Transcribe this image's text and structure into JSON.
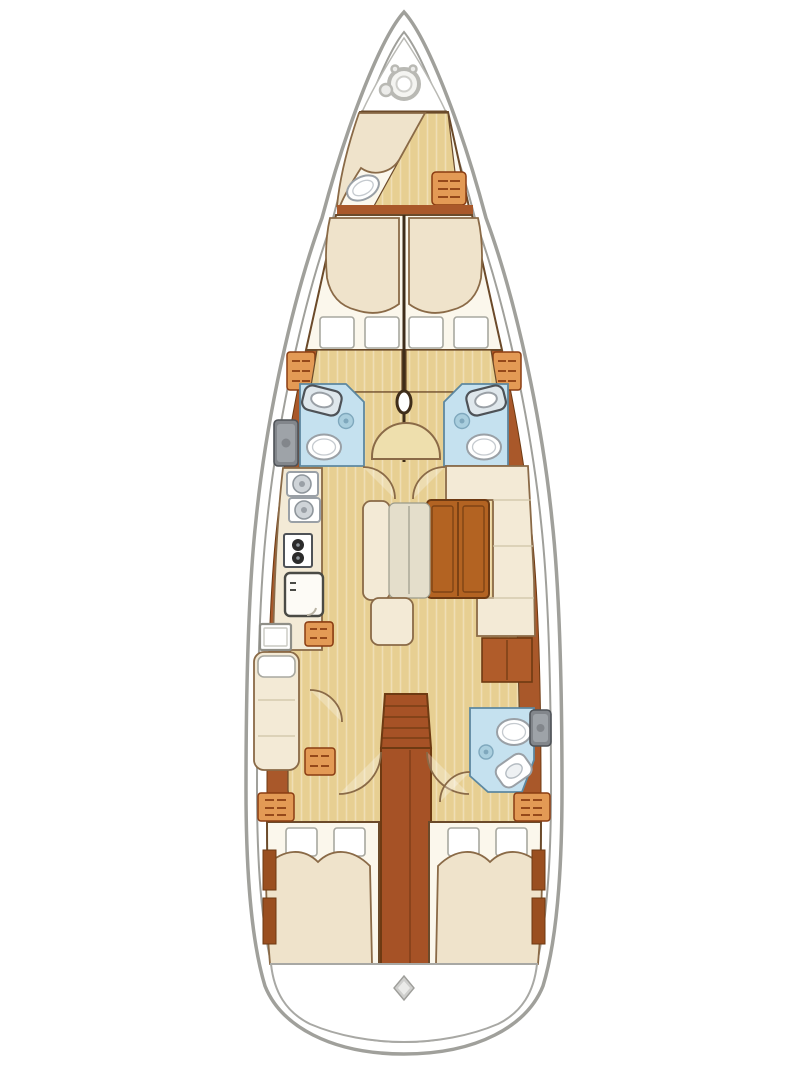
{
  "meta": {
    "title": "Sailing yacht interior layout plan, top view",
    "diagram_type": "boat-floor-plan",
    "visible_text": "none"
  },
  "palette": {
    "hull_line": "#a0a09b",
    "deck": "#ffffff",
    "wood": "#a9582a",
    "wood_mid": "#b05c2a",
    "wood_dark": "#6e3a12",
    "wood_grain": "#8a6a47",
    "wall": "#3f2d1a",
    "line": "#6b4a2a",
    "line_soft": "#8a6a47",
    "floor": "#e7cf92",
    "floor_light": "#eedfad",
    "white_soft": "#fbf7ec",
    "cream": "#f3ead6",
    "bed_cream": "#efe3cb",
    "cushion_gray": "#e4decb",
    "bath_blue": "#c5e1ef",
    "bath_deep": "#a9cede",
    "bath_edge": "#5d88a0",
    "orange": "#e39a55",
    "orange_line": "#8a3c12",
    "table": "#b36322",
    "stair": "#a65226",
    "gray_fix": "#82868b",
    "gray_dark": "#4e5257"
  },
  "rooms": [
    {
      "id": "anchor-locker",
      "label": "Anchor locker with windlass",
      "fixtures": [
        "windlass drum",
        "chain wheel"
      ]
    },
    {
      "id": "crew-cabin",
      "label": "Bow crew cabin",
      "fixtures": [
        "single berth",
        "sea toilet",
        "storage cabinet"
      ]
    },
    {
      "id": "forward-cabin-port",
      "label": "Forward double cabin, port",
      "fixtures": [
        "double berth",
        "two pillows",
        "drawer cabinet"
      ]
    },
    {
      "id": "forward-cabin-starboard",
      "label": "Forward double cabin, starboard",
      "fixtures": [
        "double berth",
        "two pillows",
        "drawer cabinet"
      ]
    },
    {
      "id": "head-port",
      "label": "En-suite head, port",
      "fixtures": [
        "washbasin",
        "shower drain",
        "toilet",
        "hull-side sink unit"
      ]
    },
    {
      "id": "head-starboard",
      "label": "En-suite head, starboard",
      "fixtures": [
        "washbasin",
        "shower drain",
        "toilet"
      ]
    },
    {
      "id": "mast-area",
      "label": "Mast step on centerline",
      "fixtures": [
        "mast",
        "curved seat"
      ]
    },
    {
      "id": "galley",
      "label": "Galley, port side",
      "fixtures": [
        "double sink",
        "two-burner stove",
        "refrigerator",
        "drawer cabinet"
      ]
    },
    {
      "id": "salon",
      "label": "Salon, starboard side",
      "fixtures": [
        "L-shaped settee",
        "folding table",
        "sideboard"
      ]
    },
    {
      "id": "port-bench",
      "label": "Port salon bench",
      "fixtures": [
        "bench cushion",
        "back cushion",
        "stool"
      ]
    },
    {
      "id": "desk-area",
      "label": "Port aft desk and berth",
      "fixtures": [
        "desk",
        "single seat berth",
        "two drawer cabinets"
      ]
    },
    {
      "id": "companionway",
      "label": "Companionway",
      "fixtures": [
        "steps",
        "engine compartment box"
      ]
    },
    {
      "id": "aft-head",
      "label": "Aft day head, starboard",
      "fixtures": [
        "toilet",
        "angled washbasin",
        "shower drain",
        "hull-side sink unit"
      ]
    },
    {
      "id": "aft-cabin-port",
      "label": "Aft double cabin, port",
      "fixtures": [
        "double berth",
        "two pillows",
        "lockers",
        "drawer cabinet"
      ]
    },
    {
      "id": "aft-cabin-starboard",
      "label": "Aft double cabin, starboard",
      "fixtures": [
        "double berth",
        "two pillows",
        "lockers",
        "drawer cabinet"
      ]
    },
    {
      "id": "transom",
      "label": "Stern swim platform",
      "fixtures": [
        "deck fitting diamond"
      ]
    }
  ]
}
